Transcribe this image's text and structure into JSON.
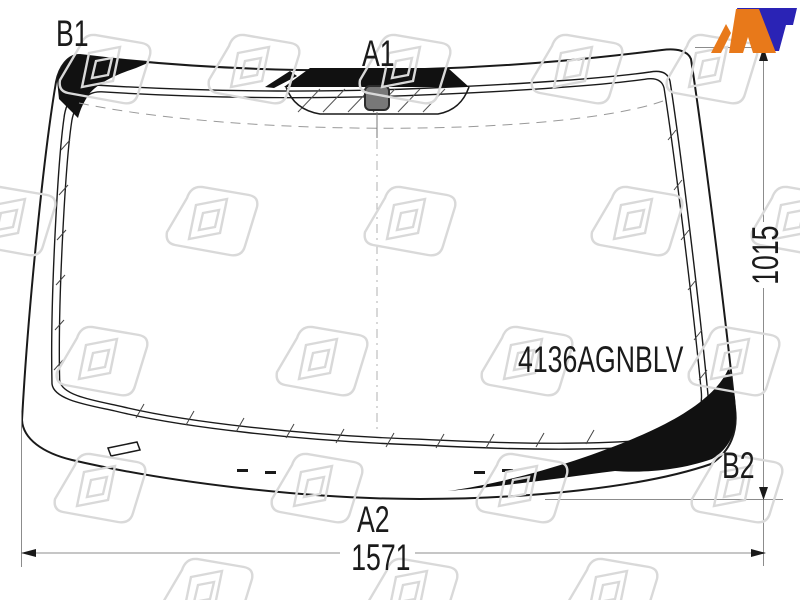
{
  "drawing": {
    "part_number": "4136AGNBLV",
    "labels": {
      "top_left": "B1",
      "top_center": "A1",
      "bottom_center": "A2",
      "bottom_right": "B2"
    },
    "dimensions": {
      "width_mm": "1571",
      "height_mm": "1015"
    },
    "brand": {
      "name": "AT",
      "color_orange": "#e8791a",
      "color_blue": "#2a23b5"
    },
    "colors": {
      "line": "#1a1a1a",
      "dimension_line": "#8c8c8c",
      "watermark": "#d9d9d9",
      "sensor_fill": "#787878"
    },
    "icons": [
      "at-logo",
      "watermark-logo",
      "rain-sensor-icon"
    ]
  }
}
